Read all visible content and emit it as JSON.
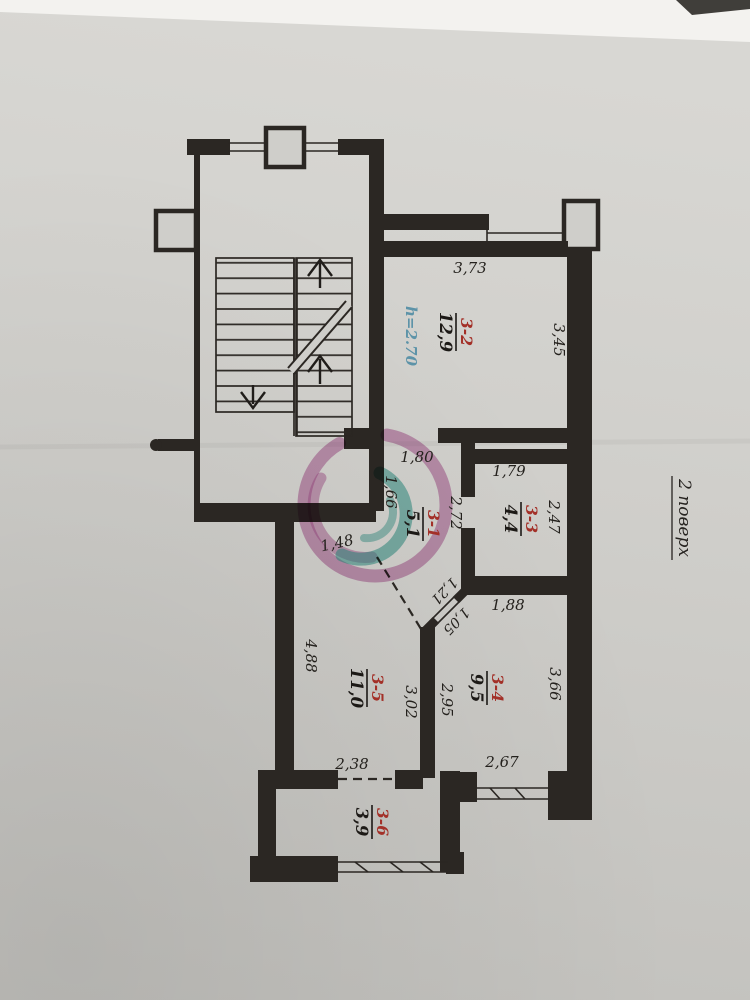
{
  "plan": {
    "floor_label": "2 поверх",
    "height_note": "h=2.70",
    "rooms": [
      {
        "id": "3-1",
        "area": "5,1"
      },
      {
        "id": "3-2",
        "area": "12,9"
      },
      {
        "id": "3-3",
        "area": "4,4"
      },
      {
        "id": "3-4",
        "area": "9,5"
      },
      {
        "id": "3-5",
        "area": "11,0"
      },
      {
        "id": "3-6",
        "area": "3,9"
      }
    ],
    "dims": {
      "room2_top": "3,73",
      "room2_right": "3,45",
      "opening_room2": "1,80",
      "room3_top": "1,79",
      "corridor_left": "1,66",
      "corridor_right": "2,72",
      "room3_right": "2,47",
      "niche": "1,48",
      "funnel_upper": "1,21",
      "funnel_lower": "1,05",
      "room4_top": "1,88",
      "room5_left": "4,88",
      "room5_right": "3,02",
      "room4_left": "2,95",
      "room4_right": "3,66",
      "room5_bottom": "2,38",
      "room4_bottom": "2,67"
    },
    "colors": {
      "room_id_red": "#a33028",
      "area_black": "#1c1916",
      "height_note_teal": "#5d93a8",
      "watermark_pink": "#b5519b",
      "watermark_teal": "#35a69b",
      "wall": "#2b2723"
    }
  }
}
